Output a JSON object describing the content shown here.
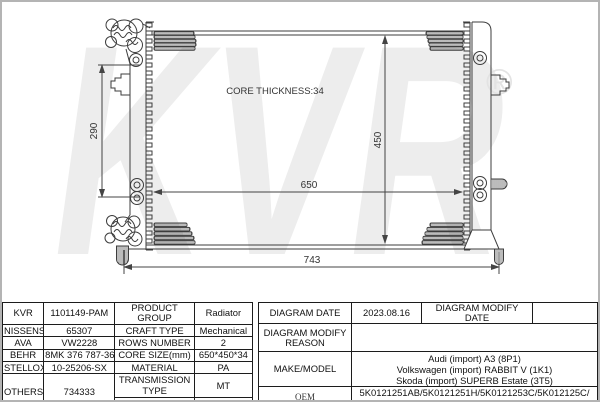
{
  "diagram": {
    "watermark": "KVR",
    "registered": "®",
    "core_thickness": "CORE THICKNESS:34",
    "dims": {
      "core_width": "650",
      "overall_width": "743",
      "core_height": "450",
      "port_spacing": "290"
    }
  },
  "table": {
    "brands": [
      {
        "name": "KVR",
        "value": "1101149-PAM"
      },
      {
        "name": "NISSENS",
        "value": "65307"
      },
      {
        "name": "AVA",
        "value": "VW2228"
      },
      {
        "name": "BEHR",
        "value": "8MK 376 787-361"
      },
      {
        "name": "STELLOX",
        "value": "10-25206-SX"
      },
      {
        "name": "OTHERS",
        "value": "734333"
      }
    ],
    "specs": [
      {
        "label": "PRODUCT GROUP",
        "value": "Radiator"
      },
      {
        "label": "CRAFT TYPE",
        "value": "Mechanical"
      },
      {
        "label": "ROWS NUMBER",
        "value": "2"
      },
      {
        "label": "CORE SIZE(mm)",
        "value": "650*450*34"
      },
      {
        "label": "MATERIAL",
        "value": "PA"
      },
      {
        "label": "TRANSMISSION TYPE",
        "value": "MT"
      },
      {
        "label": "SUPPLEMENTARY",
        "value": ""
      }
    ],
    "right": {
      "diagram_date_label": "DIAGRAM DATE",
      "diagram_date": "2023.08.16",
      "diagram_modify_date_label": "DIAGRAM MODIFY DATE",
      "diagram_modify_date": "",
      "diagram_modify_reason_label": "DIAGRAM MODIFY REASON",
      "diagram_modify_reason": "",
      "make_model_label": "MAKE/MODEL",
      "make_model_lines": [
        "Audi (import) A3 (8P1)",
        "Volkswagen (import) RABBIT V (1K1)",
        "Skoda (import) SUPERB Estate (3T5)"
      ],
      "oem_label": "OEM",
      "oem_lines": [
        "5K0121251AB/5K0121251H/5K0121253C/5K012125C/",
        "1K0.121.253 K/1K0.121.251K"
      ]
    }
  },
  "colors": {
    "line": "#3d3d3d",
    "table_border": "#1c1c1c",
    "watermark": "#ededed",
    "page_border": "#b4b4b4"
  }
}
